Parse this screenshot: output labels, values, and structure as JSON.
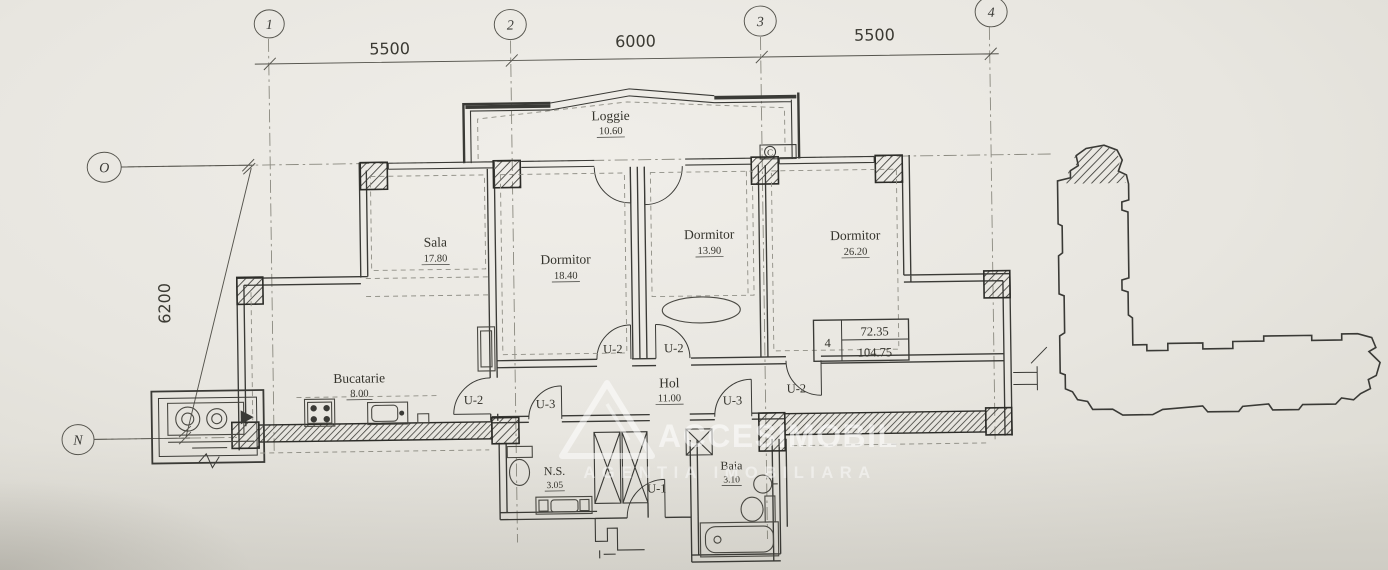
{
  "axes": {
    "columns": [
      {
        "label": "1"
      },
      {
        "label": "2"
      },
      {
        "label": "3"
      },
      {
        "label": "4"
      }
    ],
    "rows": [
      {
        "label": "O"
      },
      {
        "label": "N"
      }
    ]
  },
  "dimensions": {
    "top": [
      {
        "value": "5500"
      },
      {
        "value": "6000"
      },
      {
        "value": "5500"
      }
    ],
    "left": {
      "value": "6200"
    }
  },
  "rooms": {
    "loggie": {
      "name": "Loggie",
      "area": "10.60"
    },
    "sala": {
      "name": "Sala",
      "area": "17.80"
    },
    "dormitor1": {
      "name": "Dormitor",
      "area": "18.40"
    },
    "dormitor2": {
      "name": "Dormitor",
      "area": "13.90"
    },
    "dormitor3": {
      "name": "Dormitor",
      "area": "26.20"
    },
    "bucatarie": {
      "name": "Bucatarie",
      "area": "8.00"
    },
    "hol": {
      "name": "Hol",
      "area": "11.00"
    },
    "ns": {
      "name": "N.S.",
      "area": "3.05"
    },
    "baia": {
      "name": "Baia",
      "area": "3.10"
    }
  },
  "doors": [
    {
      "label": "U-2"
    },
    {
      "label": "U-2"
    },
    {
      "label": "U-2"
    },
    {
      "label": "U-3"
    },
    {
      "label": "U-3"
    },
    {
      "label": "U-2"
    },
    {
      "label": "U-1"
    }
  ],
  "summary_table": {
    "apartment": "4",
    "top_value": "72.35",
    "bottom_value": "104.75"
  },
  "marks": {
    "c_box": "C"
  },
  "watermark": {
    "brand": "ACCESIMOBIL",
    "tagline": "AGENTIA IMOBILIARA"
  },
  "colors": {
    "ink": "#3a3a36",
    "paper": "#e9e7e1",
    "watermark": "rgba(255,255,255,0.55)"
  }
}
